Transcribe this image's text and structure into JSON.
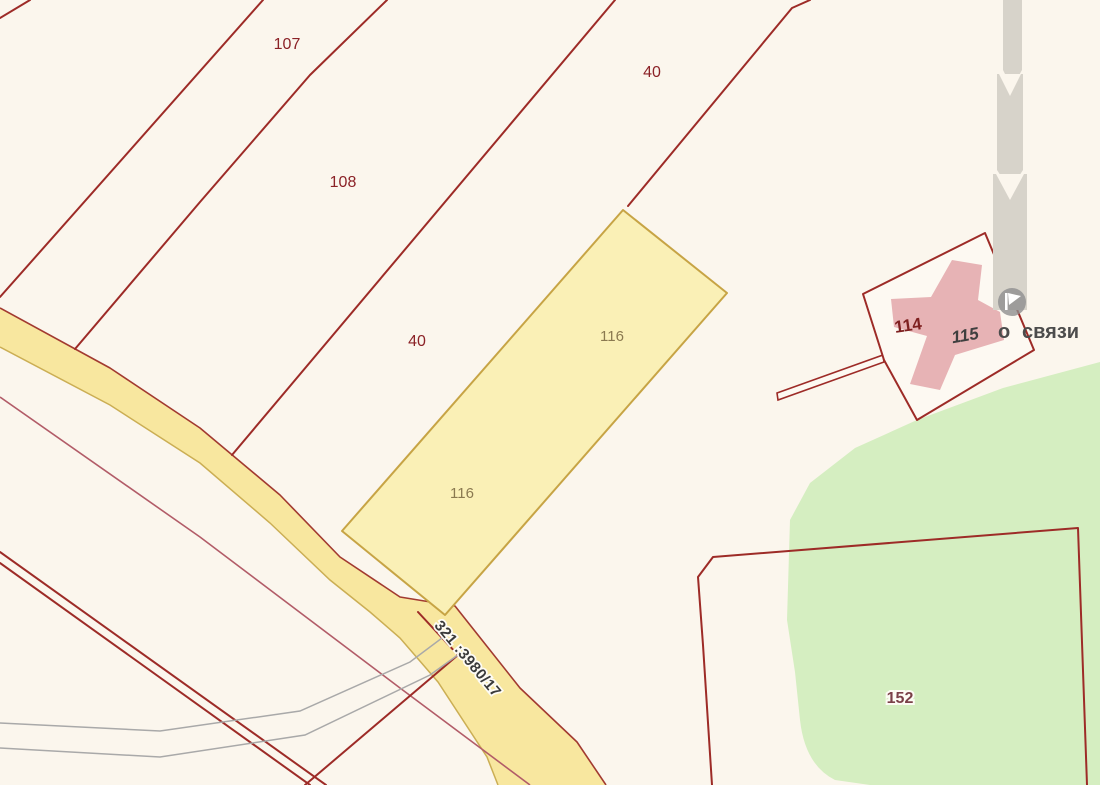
{
  "title": "Cadastral map view",
  "colors": {
    "background": "#FBF6ED",
    "boundary_red": "#9D2B27",
    "road_fill": "#F8E79F",
    "road_edge": "#CBAE54",
    "parcel116_fill": "#FAF0B6",
    "parcel116_border": "#C7A445",
    "green_fill": "#D5EEC1",
    "building_fill": "#E7B3B5",
    "structure_fill": "#FDF9F2",
    "tower_gray": "#D7D3CA",
    "pink_line": "#B25C68",
    "gray_path": "#A9A9A9",
    "poi_circle": "#8F8F8F",
    "label_red": "#8B2227",
    "label_brown": "#8A7950",
    "label_dark_gray": "#4C4C4C",
    "label_building": "#3F3F3F",
    "label_152": "#7A4048",
    "road_label_color": "#3A3A3A"
  },
  "labels": {
    "parcel107": "107",
    "parcel108": "108",
    "parcel40_upper": "40",
    "parcel40_lower": "40",
    "parcel116_upper": "116",
    "parcel116_lower": "116",
    "parcel114": "114",
    "building115": "115",
    "parcel152": "152",
    "road_number": "321 :3980/17",
    "poi_fragment": "о",
    "poi_name": "связи"
  }
}
